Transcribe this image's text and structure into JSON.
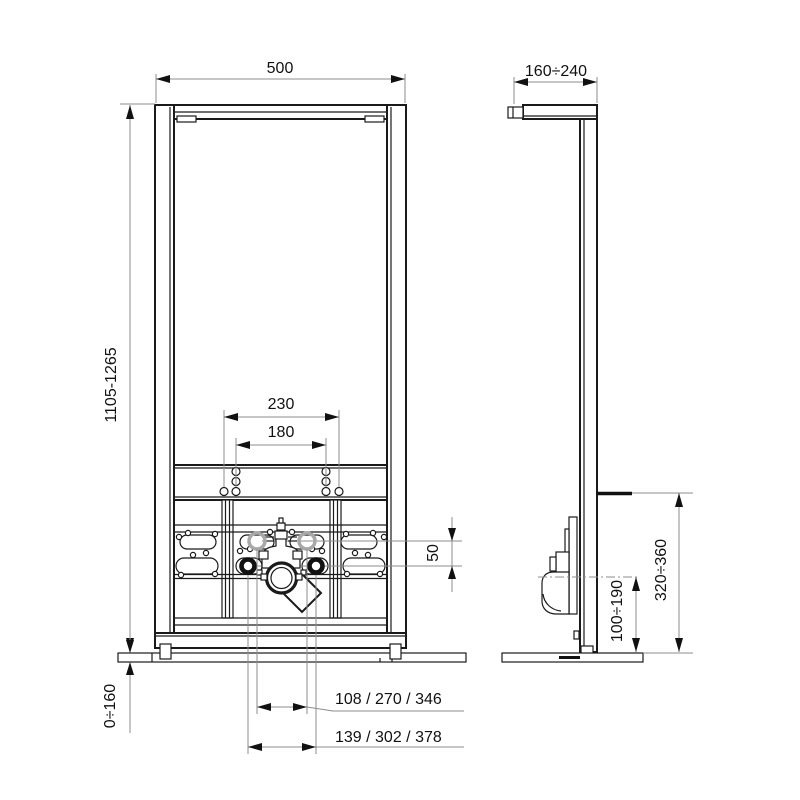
{
  "dims": {
    "front_width": "500",
    "front_height": "1105-1265",
    "holes_outer": "230",
    "holes_inner": "180",
    "offset_50": "50",
    "floor_adjust": "0÷160",
    "options_inner": "108 / 270 / 346",
    "options_outer": "139 / 302 / 378",
    "side_depth": "160÷240",
    "side_connection_height": "320÷360",
    "side_drain_height": "100÷190"
  },
  "colors": {
    "line": "#1a1a1a",
    "dimension": "#8c8c8c",
    "alternate_position": "#a8a8a8",
    "background": "#ffffff"
  }
}
